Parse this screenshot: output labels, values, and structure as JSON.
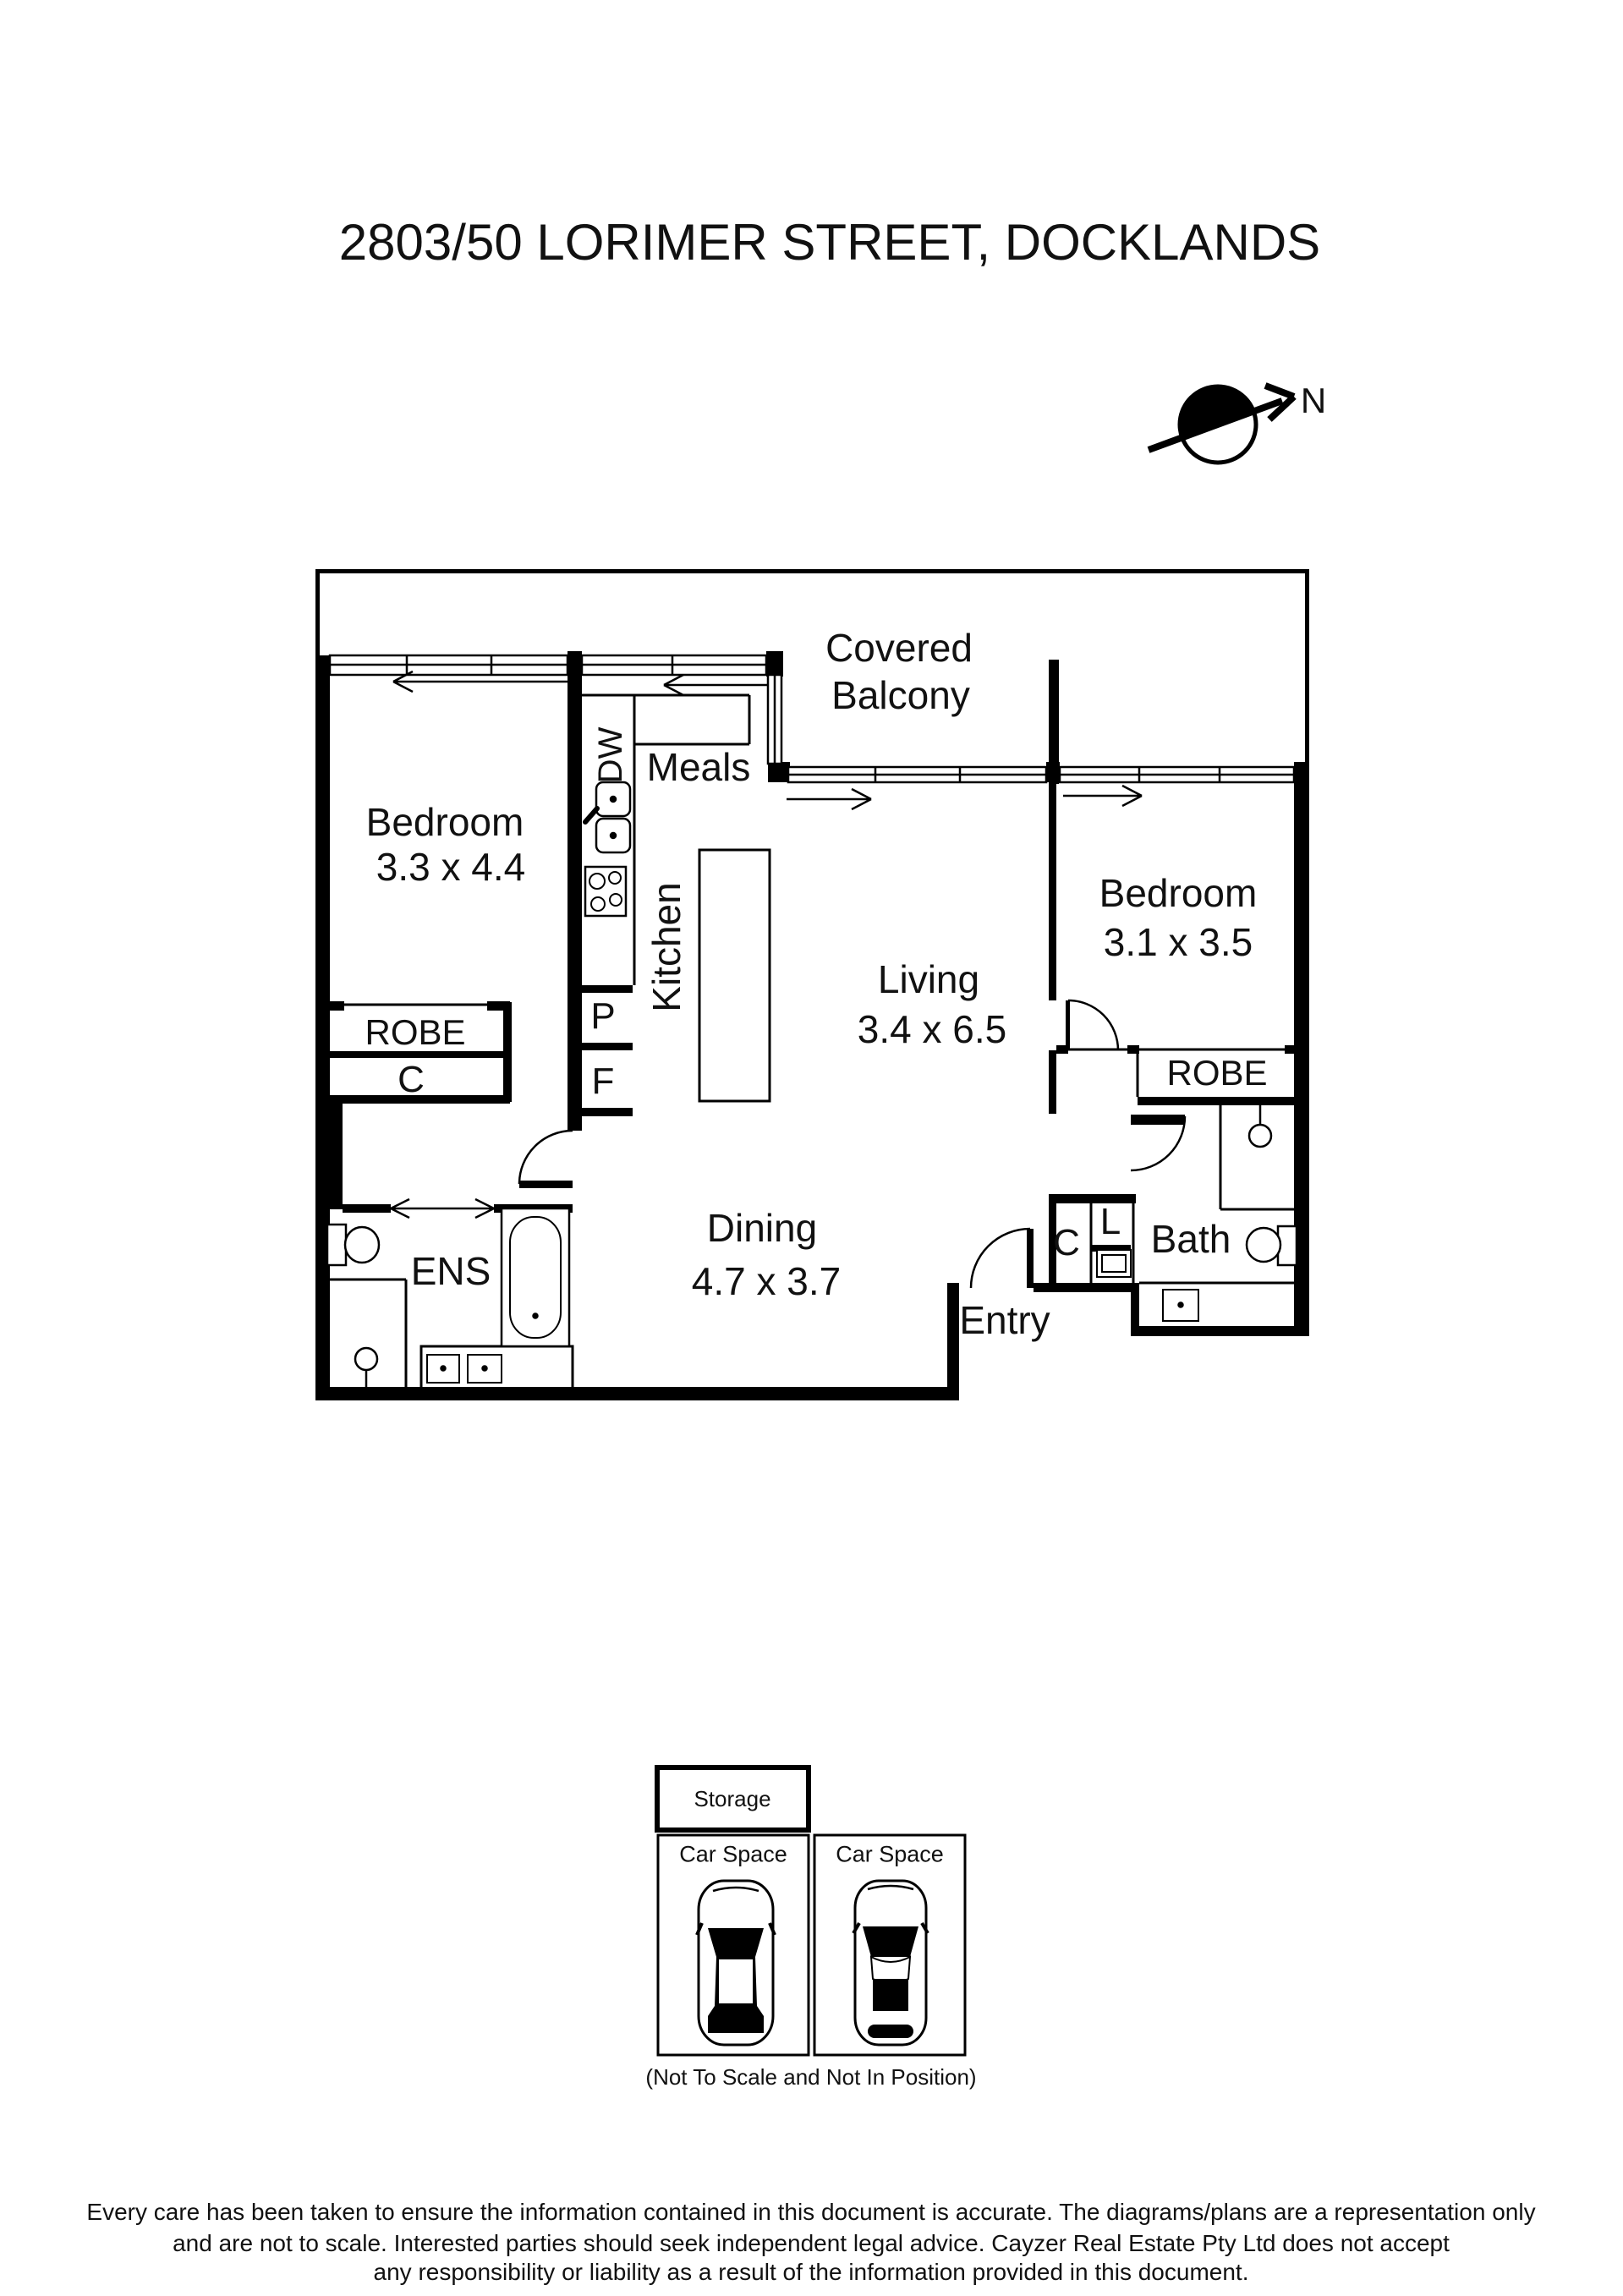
{
  "title": "2803/50 LORIMER STREET, DOCKLANDS",
  "compass": {
    "north_label": "N"
  },
  "plan": {
    "balcony": {
      "line1": "Covered",
      "line2": "Balcony"
    },
    "bedroom1": {
      "name": "Bedroom",
      "dim": "3.3 x 4.4",
      "robe": "ROBE",
      "closet": "C"
    },
    "kitchen": {
      "name": "Kitchen",
      "dishwasher": "DW",
      "pantry": "P",
      "fridge": "F",
      "meals": "Meals"
    },
    "living": {
      "name": "Living",
      "dim": "3.4 x 6.5"
    },
    "dining": {
      "name": "Dining",
      "dim": "4.7 x 3.7"
    },
    "bedroom2": {
      "name": "Bedroom",
      "dim": "3.1 x 3.5",
      "robe": "ROBE"
    },
    "ensuite": {
      "name": "ENS"
    },
    "bath": {
      "name": "Bath",
      "closet": "C",
      "laundry": "L"
    },
    "entry": {
      "name": "Entry"
    }
  },
  "parking": {
    "storage_label": "Storage",
    "car_space_1_label": "Car Space",
    "car_space_2_label": "Car Space",
    "note": "(Not To Scale and Not In Position)"
  },
  "disclaimer": {
    "line1": "Every care has been taken to ensure the information contained in this document is accurate. The diagrams/plans are a representation only",
    "line2": "and are not to scale. Interested parties should seek independent legal advice. Cayzer Real Estate Pty Ltd does not accept",
    "line3": "any responsibility or liability as a result of the information provided in this document."
  }
}
